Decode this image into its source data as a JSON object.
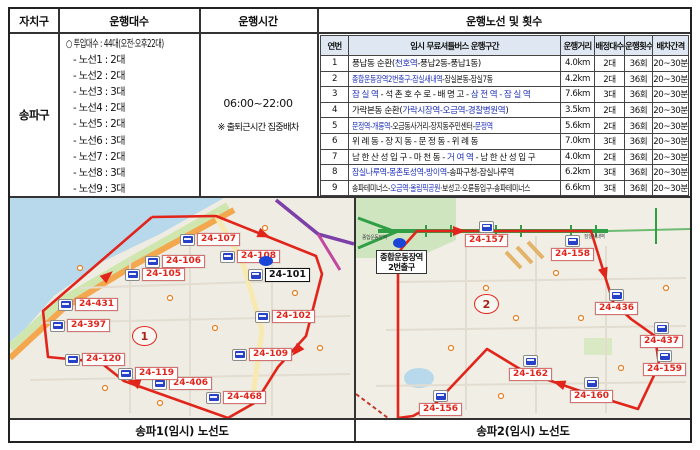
{
  "summary_table": {
    "headers": [
      "자치구",
      "운행대수",
      "운행시간"
    ],
    "district": "송파구",
    "fleet": {
      "total": "○ 투입대수 : 44대(오전·오후22대)",
      "lines": [
        "- 노선1 : 2대",
        "- 노선2 : 2대",
        "- 노선3 : 3대",
        "- 노선4 : 2대",
        "- 노선5 : 2대",
        "- 노선6 : 3대",
        "- 노선7 : 2대",
        "- 노선8 : 3대",
        "- 노선9 : 3대"
      ]
    },
    "hours": {
      "time": "06:00~22:00",
      "note": "※ 출퇴근시간 집중배차"
    }
  },
  "route_table": {
    "title": "운행노선 및 횟수",
    "headers": [
      "연번",
      "임시 무료셔틀버스 운행구간",
      "운행거리",
      "배정대수",
      "운행횟수",
      "배차간격"
    ],
    "rows": [
      {
        "no": "1",
        "fit": "",
        "section": [
          {
            "t": "풍납동 순환("
          },
          {
            "t": "천호역",
            "b": true
          },
          {
            "t": "-풍납2동-풍납1동)"
          }
        ],
        "distance": "4.0km",
        "buses": "2대",
        "trips": "36회",
        "interval": "20~30분"
      },
      {
        "no": "2",
        "fit": "squeeze",
        "section": [
          {
            "t": "종합운동장역2번출구-잠실새내역",
            "b": true
          },
          {
            "t": "-잠실본동-잠실7동"
          }
        ],
        "distance": "4.2km",
        "buses": "2대",
        "trips": "36회",
        "interval": "20~30분"
      },
      {
        "no": "3",
        "fit": "wide",
        "section": [
          {
            "t": "잠실역",
            "b": true
          },
          {
            "t": "-석촌호수로-배명고-"
          },
          {
            "t": "삼전역-잠실역",
            "b": true
          }
        ],
        "distance": "7.6km",
        "buses": "3대",
        "trips": "36회",
        "interval": "20~30분"
      },
      {
        "no": "4",
        "fit": "",
        "section": [
          {
            "t": "가락본동 순환("
          },
          {
            "t": "가락시장역-오금역-경찰병원역",
            "b": true
          },
          {
            "t": ")"
          }
        ],
        "distance": "3.5km",
        "buses": "2대",
        "trips": "36회",
        "interval": "20~30분"
      },
      {
        "no": "5",
        "fit": "squeeze",
        "section": [
          {
            "t": "문정역-개롱역",
            "b": true
          },
          {
            "t": "-오금동사거리-장지동주민센터-"
          },
          {
            "t": "문정역",
            "b": true
          }
        ],
        "distance": "5.6km",
        "buses": "2대",
        "trips": "36회",
        "interval": "20~30분"
      },
      {
        "no": "6",
        "fit": "wide",
        "section": [
          {
            "t": "위례동-장지동-문정동-위례동"
          }
        ],
        "distance": "7.0km",
        "buses": "3대",
        "trips": "36회",
        "interval": "20~30분"
      },
      {
        "no": "7",
        "fit": "wide",
        "section": [
          {
            "t": "남한산성입구-마천동-"
          },
          {
            "t": "거여역",
            "b": true
          },
          {
            "t": "-남한산성입구"
          }
        ],
        "distance": "4.0km",
        "buses": "2대",
        "trips": "36회",
        "interval": "20~30분"
      },
      {
        "no": "8",
        "fit": "squeeze2",
        "section": [
          {
            "t": "잠실나루역-몽촌토성역-방이역",
            "b": true
          },
          {
            "t": "-송파구청-잠실나루역"
          }
        ],
        "distance": "6.2km",
        "buses": "3대",
        "trips": "36회",
        "interval": "20~30분"
      },
      {
        "no": "9",
        "fit": "squeeze",
        "section": [
          {
            "t": "송파테미너스-"
          },
          {
            "t": "오금역·올림픽공원",
            "b": true
          },
          {
            "t": "·보성고·오륜동입구-송파테미너스"
          }
        ],
        "distance": "6.6km",
        "buses": "3대",
        "trips": "36회",
        "interval": "20~30분"
      }
    ]
  },
  "maps": [
    {
      "caption": "송파1(임시) 노선도",
      "route_number": "1",
      "stops": [
        {
          "id": "24-107",
          "x": 170,
          "y": 35
        },
        {
          "id": "24-106",
          "x": 135,
          "y": 57
        },
        {
          "id": "24-105",
          "x": 115,
          "y": 70
        },
        {
          "id": "24-108",
          "x": 210,
          "y": 52
        },
        {
          "id": "24-101",
          "x": 238,
          "y": 70,
          "hl": true
        },
        {
          "id": "24-102",
          "x": 245,
          "y": 112
        },
        {
          "id": "24-109",
          "x": 222,
          "y": 150
        },
        {
          "id": "24-468",
          "x": 196,
          "y": 193
        },
        {
          "id": "24-406",
          "x": 142,
          "y": 179
        },
        {
          "id": "24-119",
          "x": 108,
          "y": 169
        },
        {
          "id": "24-120",
          "x": 55,
          "y": 155
        },
        {
          "id": "24-397",
          "x": 40,
          "y": 121
        },
        {
          "id": "24-431",
          "x": 48,
          "y": 100
        }
      ]
    },
    {
      "caption": "송파2(임시) 노선도",
      "route_number": "2",
      "start_label_line1": "종합운동장역",
      "start_label_line2": "2번출구",
      "station_labels": [
        "종합운동장역",
        "잠실새내역"
      ],
      "stops": [
        {
          "id": "24-157",
          "x": 109,
          "y": 23,
          "v": true
        },
        {
          "id": "24-158",
          "x": 195,
          "y": 37,
          "v": true
        },
        {
          "id": "24-436",
          "x": 239,
          "y": 91,
          "v": true
        },
        {
          "id": "24-437",
          "x": 284,
          "y": 124,
          "v": true
        },
        {
          "id": "24-159",
          "x": 287,
          "y": 152,
          "v": true
        },
        {
          "id": "24-162",
          "x": 153,
          "y": 157,
          "v": true
        },
        {
          "id": "24-160",
          "x": 214,
          "y": 179,
          "v": true
        },
        {
          "id": "24-156",
          "x": 63,
          "y": 192,
          "v": true
        }
      ]
    }
  ],
  "colors": {
    "route_red": "#e1251b",
    "station_blue": "#2233bb",
    "table_header_bg": "#dfe8f2"
  }
}
